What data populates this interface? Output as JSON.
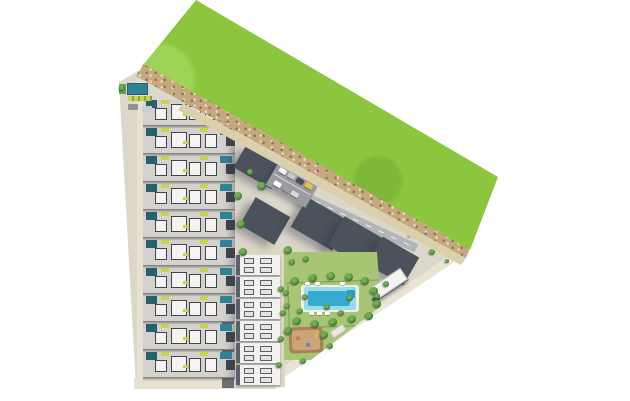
{
  "scene": {
    "type": "aerial-3d-site-plan-render",
    "canvas": {
      "width": 630,
      "height": 401
    },
    "visible_text": []
  },
  "palette": {
    "white": "#ffffff",
    "grass": "#8cc63e",
    "grassLight": "#9ed455",
    "grassDark": "#7db838",
    "dirt": "#c4a87f",
    "dirtDark": "#8d7550",
    "sand": "#dccfae",
    "ground": "#dcd7cb",
    "walk": "#ece4d2",
    "walk2": "#e9e1d0",
    "path": "#ddd6c6",
    "roadDark": "#6b6e73",
    "roadLight": "#b4b5b8",
    "rowBase": "#d5d2ce",
    "roofWhite": "#f5f4f2",
    "rowDark": "#3f444c",
    "poolTeal": "#27606c",
    "poolTealLight": "#2e8296",
    "accent": "#c8d34c",
    "blockWhite": "#f3f2f0",
    "blockLine": "#4b525c",
    "col2White": "#f2f1ef",
    "col2Line": "#5a6069",
    "asphalt": "#9b9ca1",
    "lawn": "#a8c575",
    "hedge": "#71a14e",
    "treeDark": "#3a6d33",
    "treeLight": "#6fae4e",
    "poolLight": "#9adbe8",
    "poolDeep": "#35abd0",
    "deck": "#f0efe9",
    "playBrown": "#a8805c",
    "playSand": "#c9a578",
    "wallDark": "#565c64"
  },
  "townhouse_column": {
    "x": 143,
    "width": 92,
    "start_y": 100,
    "row_pitch": 28,
    "row_height": 26,
    "count": 10
  },
  "apartment_column": {
    "x": 236,
    "width": 44,
    "start_y": 255,
    "row_pitch": 22,
    "row_height": 20,
    "count": 6
  },
  "blocks": [
    {
      "cx": 259,
      "cy": 167,
      "w": 44,
      "h": 26,
      "angle": 30,
      "cols": 3,
      "rows": 2
    },
    {
      "cx": 265,
      "cy": 221,
      "w": 40,
      "h": 32,
      "angle": 30,
      "cols": 3,
      "rows": 2
    },
    {
      "cx": 320,
      "cy": 224,
      "w": 48,
      "h": 34,
      "angle": 30,
      "cols": 4,
      "rows": 2
    },
    {
      "cx": 357,
      "cy": 243,
      "w": 48,
      "h": 34,
      "angle": 30,
      "cols": 4,
      "rows": 2
    },
    {
      "cx": 393,
      "cy": 261,
      "w": 42,
      "h": 32,
      "angle": 30,
      "cols": 4,
      "rows": 2
    }
  ],
  "parking_cars": [
    {
      "x": 4,
      "y": 3,
      "color": "#f4f4f4"
    },
    {
      "x": 14,
      "y": 3,
      "color": "#c7cacd"
    },
    {
      "x": 24,
      "y": 3,
      "color": "#4a4e55"
    },
    {
      "x": 34,
      "y": 3,
      "color": "#e4c23e"
    },
    {
      "x": 6,
      "y": 17,
      "color": "#ffffff"
    },
    {
      "x": 16,
      "y": 17,
      "color": "#9aa0a6"
    },
    {
      "x": 26,
      "y": 17,
      "color": "#d8d8d8"
    }
  ],
  "trees": [
    [
      238,
      196,
      4
    ],
    [
      241,
      224,
      4
    ],
    [
      243,
      252,
      4
    ],
    [
      262,
      186,
      4
    ],
    [
      250,
      172,
      3
    ],
    [
      288,
      250,
      4
    ],
    [
      292,
      262,
      3
    ],
    [
      306,
      259,
      3
    ],
    [
      295,
      281,
      4
    ],
    [
      313,
      278,
      4
    ],
    [
      331,
      276,
      4
    ],
    [
      349,
      277,
      4
    ],
    [
      365,
      281,
      4
    ],
    [
      374,
      291,
      4
    ],
    [
      377,
      304,
      4
    ],
    [
      369,
      316,
      4
    ],
    [
      352,
      319,
      4
    ],
    [
      333,
      322,
      4
    ],
    [
      315,
      324,
      4
    ],
    [
      297,
      321,
      4
    ],
    [
      287,
      306,
      3
    ],
    [
      286,
      293,
      3
    ],
    [
      305,
      297,
      3
    ],
    [
      327,
      307,
      3
    ],
    [
      350,
      298,
      3
    ],
    [
      341,
      313,
      3
    ],
    [
      300,
      311,
      3
    ],
    [
      288,
      331,
      4
    ],
    [
      324,
      335,
      4
    ],
    [
      281,
      289,
      3
    ],
    [
      283,
      313,
      3
    ],
    [
      281,
      339,
      3
    ],
    [
      279,
      365,
      3
    ],
    [
      377,
      296,
      3
    ],
    [
      386,
      284,
      3
    ],
    [
      330,
      346,
      3
    ],
    [
      303,
      361,
      3
    ],
    [
      432,
      252,
      3
    ],
    [
      447,
      261,
      2
    ],
    [
      212,
      122,
      2
    ],
    [
      262,
      150,
      2
    ],
    [
      312,
      179,
      2
    ],
    [
      362,
      207,
      2
    ],
    [
      410,
      235,
      2
    ],
    [
      122,
      88,
      3
    ]
  ],
  "loungers": [
    [
      309,
      312
    ],
    [
      317,
      312
    ],
    [
      325,
      312
    ],
    [
      305,
      282
    ],
    [
      315,
      282
    ],
    [
      340,
      282
    ]
  ],
  "playground_dots": [
    {
      "x": 7,
      "y": 9,
      "color": "#d9734f"
    },
    {
      "x": 17,
      "y": 16,
      "color": "#4a89c8"
    },
    {
      "x": 25,
      "y": 7,
      "color": "#e0b43f"
    }
  ]
}
